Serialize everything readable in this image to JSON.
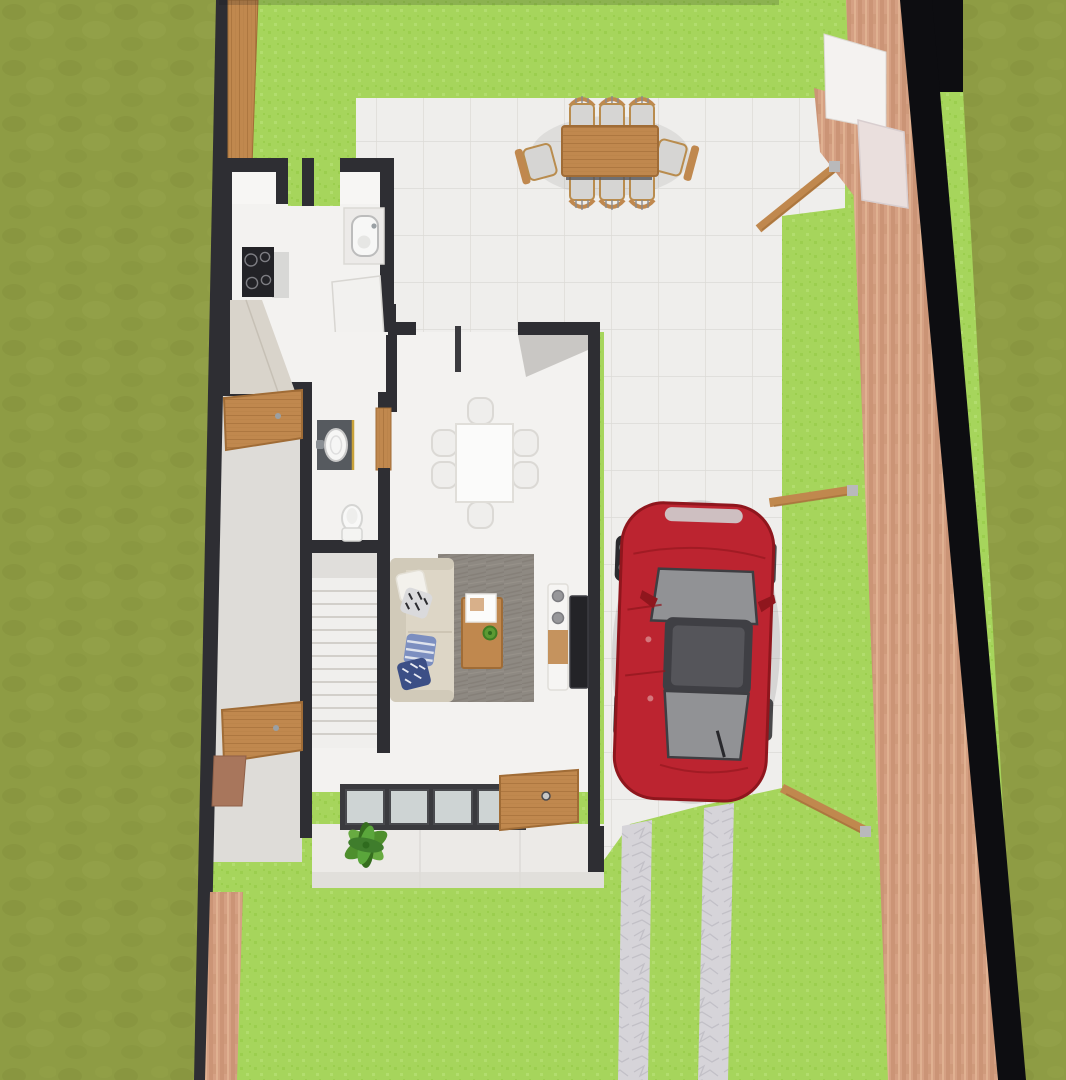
{
  "meta": {
    "description": "Top-down 3D architectural rendering of a single-family house lot: walled garden, terrace with outdoor dining set, one-storey floor plan (kitchen, dining room, bathroom, staircase, living room), driveway with parked red hatchback, stone wheel tracks, brick perimeter wall",
    "view": "bird's-eye / plan view",
    "visible_text": "none"
  },
  "colors": {
    "lawn": "#a6d55c",
    "lawnDot": "#9bce4e",
    "lawnDot2": "#b2dd6e",
    "grassOuter": "#8e9c44",
    "grassOuterDark": "#83903b",
    "grassOuterLight": "#99a64e",
    "tile": "#efeeec",
    "grout": "#dcdad6",
    "wallDark": "#2e2e33",
    "black": "#0d0d11",
    "brick": "#d5a083",
    "brickDark": "#c28b6b",
    "brickLight": "#e6b897",
    "wood": "#c0884e",
    "woodDark": "#a06c36",
    "stone": "#d6d4d9",
    "stoneLine": "#c2c0c7",
    "floorPassage": "#dedcd8",
    "porch": "#eceae7",
    "interiorWhite": "#f3f2f0",
    "counter": "#d9d4cb",
    "cooktop": "#232327",
    "vanity": "#565a5f",
    "gold": "#c9a23a",
    "porcelain": "#f8f8f7",
    "rug": "#8e8982",
    "sofa": "#ddd6c6",
    "sofaBack": "#d1cab9",
    "pillowWhite": "#f3f1ec",
    "pillowBW": "#dadadc",
    "pillowBlue": "#7c8fc0",
    "pillowNavy": "#3c4f86",
    "glassDoor": "#ced4d4",
    "marble": "#eadfdd",
    "carRed": "#bc2430",
    "carRedDark": "#8f161d",
    "carGlass": "#919295",
    "carRoof": "#3f3f44",
    "carTrim": "#2a2a2e",
    "carSilver": "#cfd0d2",
    "tvDark": "#232327",
    "speaker": "#97979a",
    "chairGray": "#d6d5d3",
    "plantGreen": "#4e8f2d",
    "plantGreenDark": "#356d1e",
    "plantGreenLight": "#68ab41"
  },
  "scene": {
    "areas": [
      "left-yard",
      "garden-lawn",
      "courtyard",
      "terrace",
      "driveway",
      "entry-porch",
      "side-passage",
      "kitchen",
      "dining-room",
      "bathroom",
      "staircase",
      "living-room"
    ],
    "objects": [
      {
        "name": "outdoor-dining-set",
        "detail": "wooden table with 8 chairs on terrace"
      },
      {
        "name": "indoor-dining-set",
        "detail": "white table with 6 chairs"
      },
      {
        "name": "kitchen-cooktop",
        "burners": 4
      },
      {
        "name": "kitchen-sink",
        "detail": "counter-mounted basin"
      },
      {
        "name": "kitchen-cabinet",
        "detail": "white island / fridge block"
      },
      {
        "name": "bathroom-vanity",
        "detail": "dark vanity with oval sink, gold trim"
      },
      {
        "name": "toilet"
      },
      {
        "name": "staircase",
        "treads": 12
      },
      {
        "name": "sofa",
        "detail": "beige, four throw pillows"
      },
      {
        "name": "area-rug",
        "detail": "mottled grey"
      },
      {
        "name": "coffee-table",
        "detail": "wood, open magazine and potted plant"
      },
      {
        "name": "tv-stand",
        "detail": "white tower with two speakers"
      },
      {
        "name": "tv",
        "detail": "dark flat panel"
      },
      {
        "name": "red-car",
        "detail": "hatchback parked on driveway facing the terrace"
      },
      {
        "name": "sliding-glass-door",
        "panes": 4
      },
      {
        "name": "front-door",
        "material": "wood, shown open"
      },
      {
        "name": "side-door",
        "count": 2,
        "detail": "wooden doors across side passage"
      },
      {
        "name": "gate-arm",
        "count": 3,
        "detail": "wooden beams hinged on brick wall"
      },
      {
        "name": "stone-wheel-track",
        "count": 2
      },
      {
        "name": "entry-plant",
        "detail": "green shrub at porch"
      },
      {
        "name": "brick-perimeter-wall",
        "detail": "right boundary with gate pillar"
      },
      {
        "name": "marble-gate-pillar"
      },
      {
        "name": "wood-fence-plank",
        "detail": "top-left boundary"
      }
    ]
  }
}
